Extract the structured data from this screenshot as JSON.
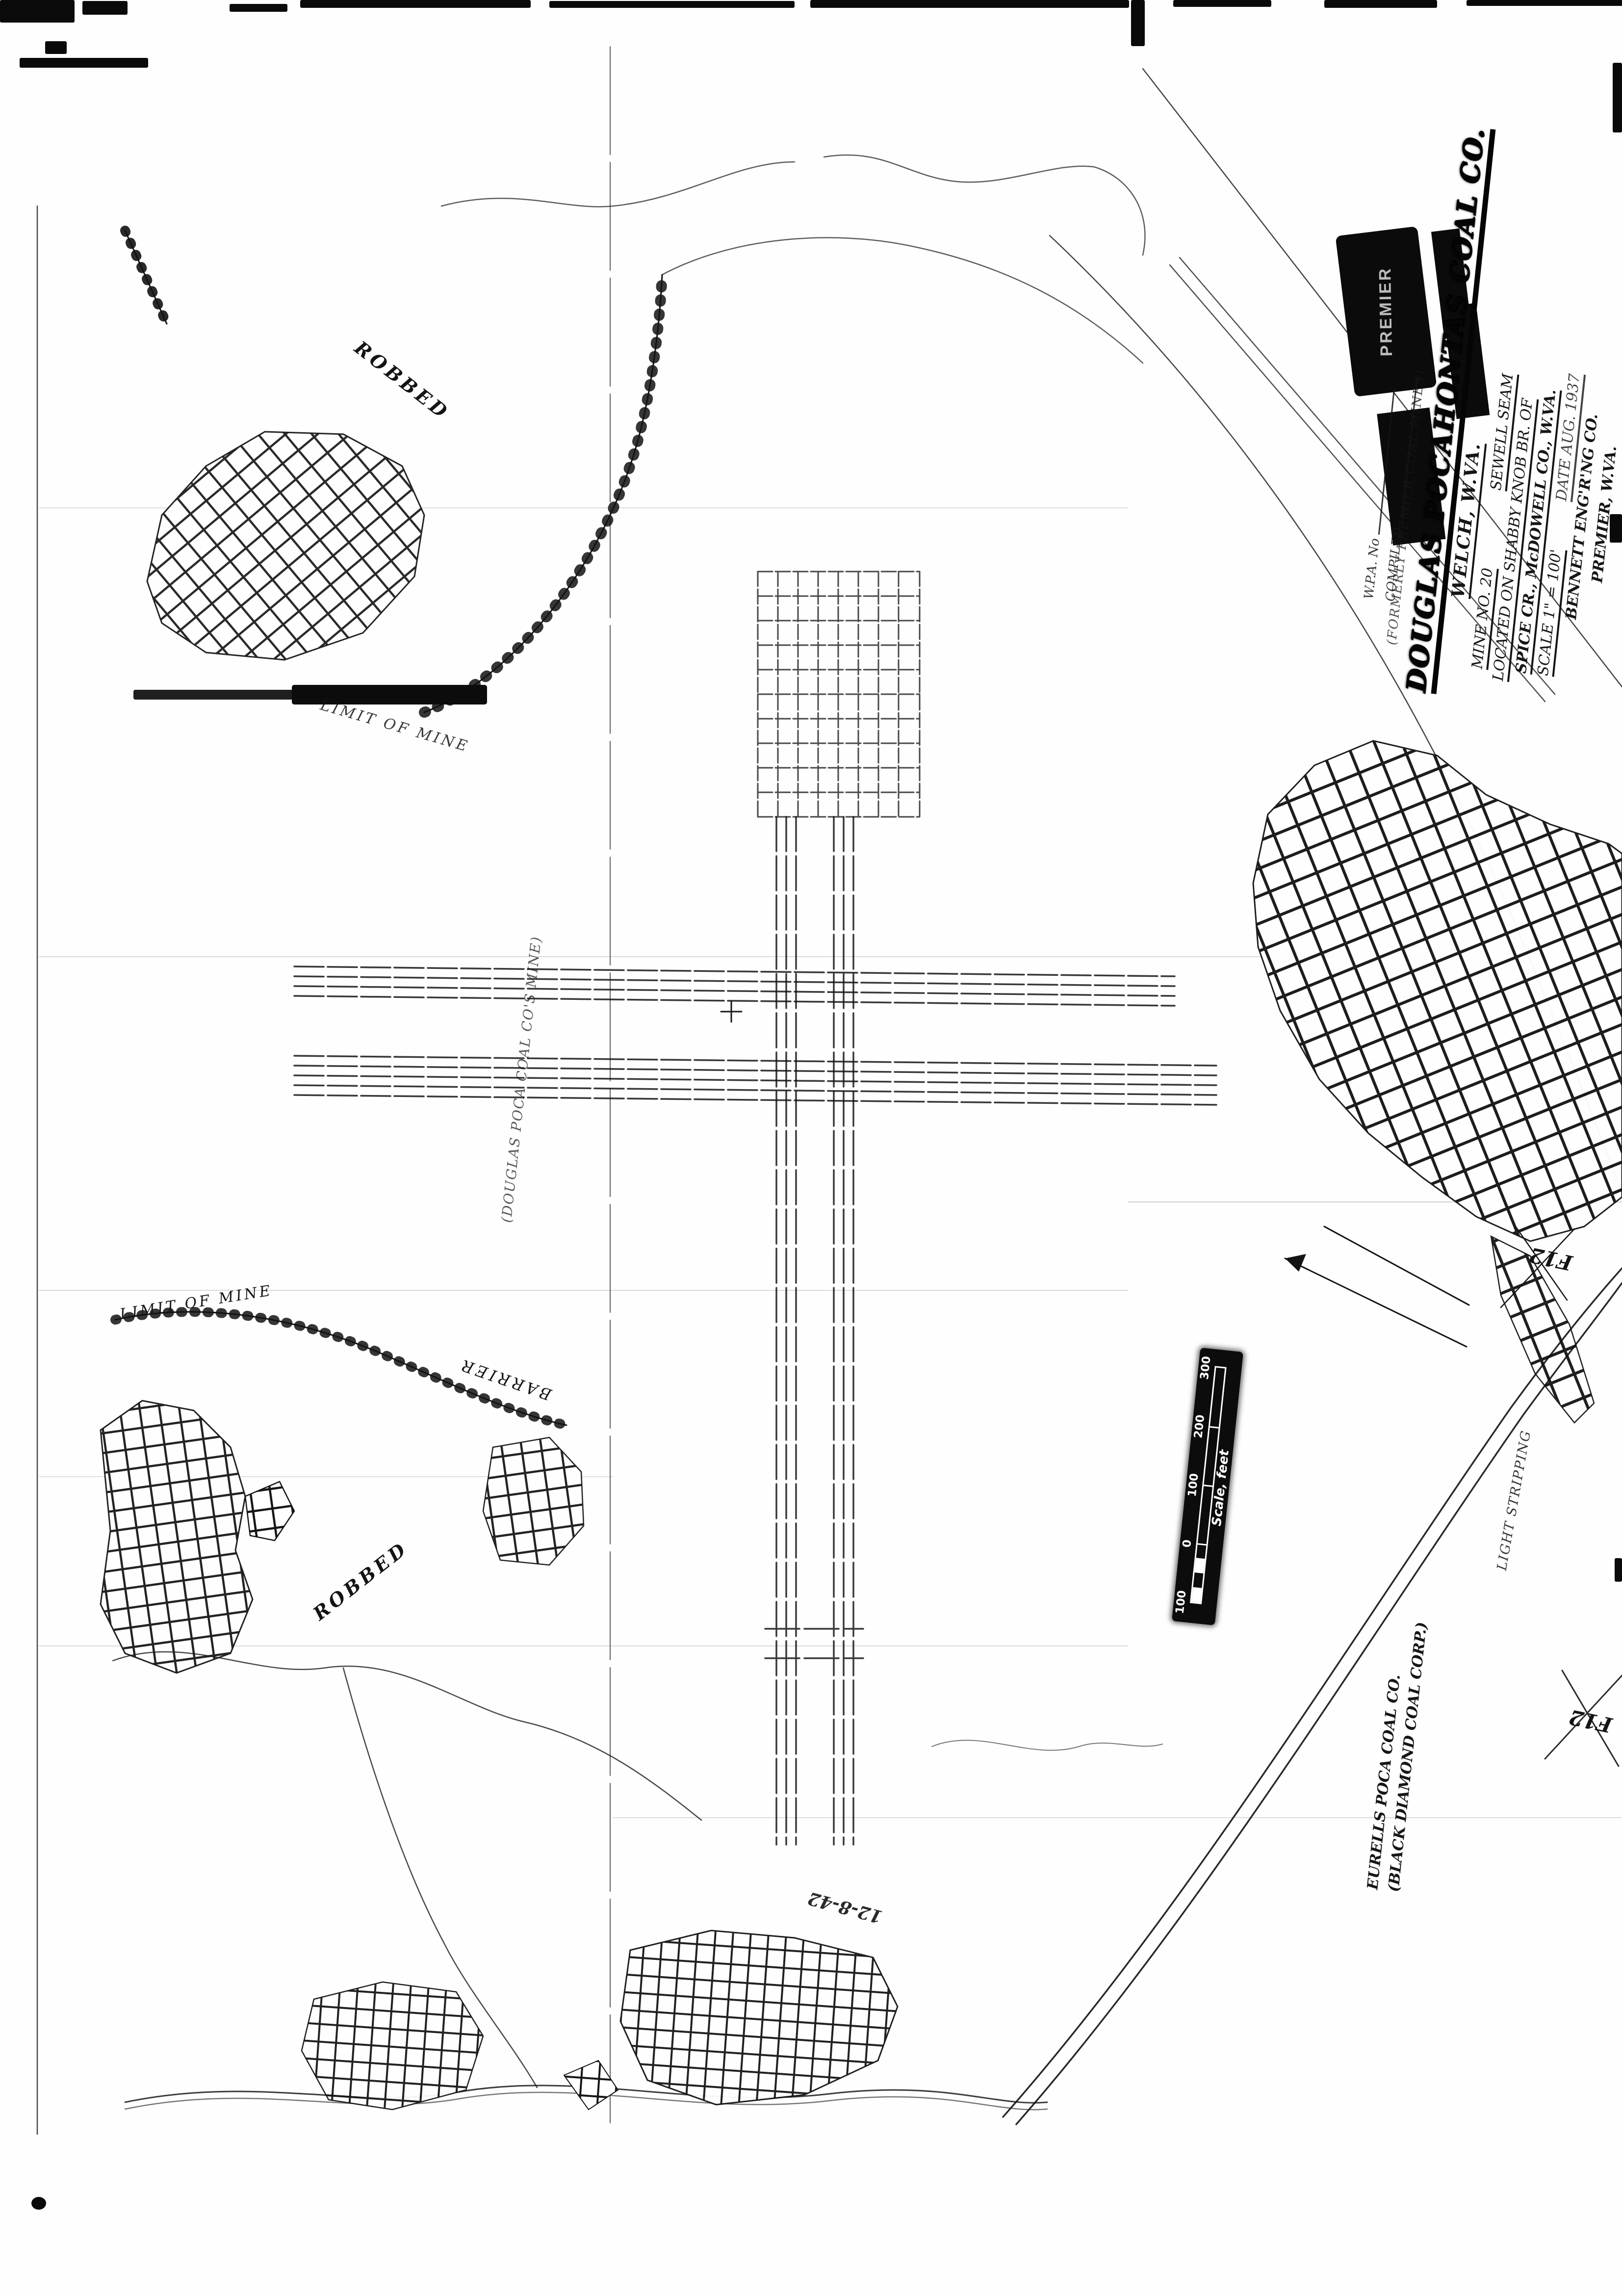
{
  "stamp": {
    "text": "PREMIER"
  },
  "title_block": {
    "wpa_label": "W.P.A. No",
    "compiled_label": "COMPILED",
    "former_note": "(FORMERLY PREMIER COAL MINES)",
    "company": "DOUGLAS POCAHONTAS COAL CO.",
    "company_location": "WELCH, W.VA.",
    "mine_no": "MINE NO. 20",
    "seam": "SEWELL SEAM",
    "located1": "LOCATED ON SHABBY KNOB BR. OF",
    "located2": "SPICE CR., McDOWELL CO., W.VA.",
    "scale": "SCALE 1\" = 100'",
    "date": "DATE AUG. 1937",
    "engineer": "BENNETT ENG'R'NG CO.",
    "engineer_location": "PREMIER, W.VA."
  },
  "scale_bar": {
    "label": "Scale, feet",
    "ticks": [
      "100",
      "0",
      "100",
      "200",
      "300"
    ]
  },
  "map_labels": {
    "robbed_upper": "ROBBED",
    "robbed_lower": "ROBBED",
    "limit_of_mine_a": "LIMIT OF MINE",
    "limit_of_mine_b": "LIMIT OF MINE",
    "barrier": "BARRIER",
    "company_mine_note": "(DOUGLAS POCA COAL CO'S MINE)",
    "grid_ref_a": "F12",
    "grid_ref_b": "F12",
    "stripping_note": "LIGHT STRIPPING",
    "adjacent_owner_line1": "EURELLS POCA COAL CO.",
    "adjacent_owner_line2": "(BLACK DIAMOND COAL CORP.)",
    "date_scrawl": "12-8-42"
  }
}
